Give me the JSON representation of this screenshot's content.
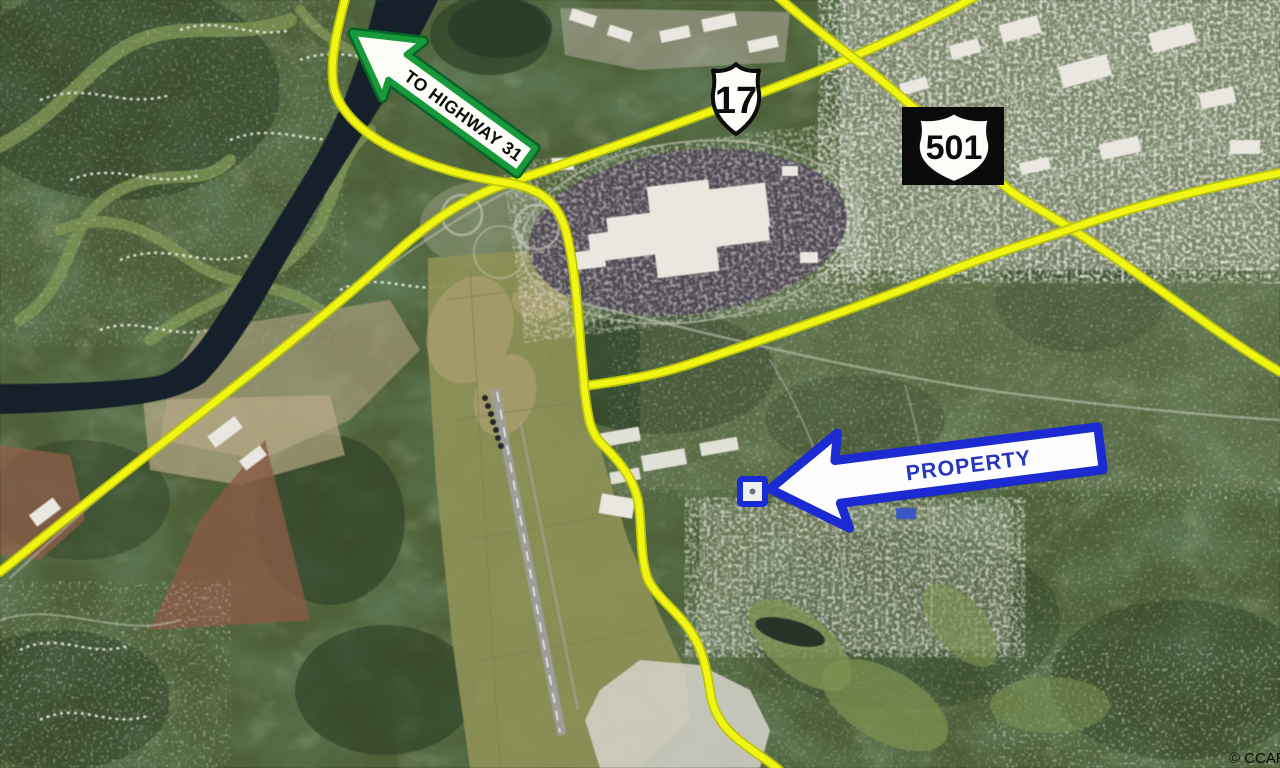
{
  "map": {
    "credit": "© CCAR",
    "annotations": {
      "to_highway_arrow": {
        "label": "TO HIGHWAY 31"
      },
      "shield_17": {
        "route": "17"
      },
      "shield_501": {
        "route": "501"
      },
      "property_arrow": {
        "label": "PROPERTY"
      },
      "property_marker": {
        "shape": "square-outline"
      }
    },
    "colors": {
      "forest-base": "#4e6038",
      "river": "#15202a",
      "highway-yellow": "#f0f514",
      "highway-yellow-edge": "#bcc40b",
      "arrow-green": "#17993c",
      "arrow-green-dark": "#0a6326",
      "arrow-blue": "#1b2bd1",
      "text-blue": "#2636be",
      "marker-blue": "#1a2bd6"
    }
  }
}
